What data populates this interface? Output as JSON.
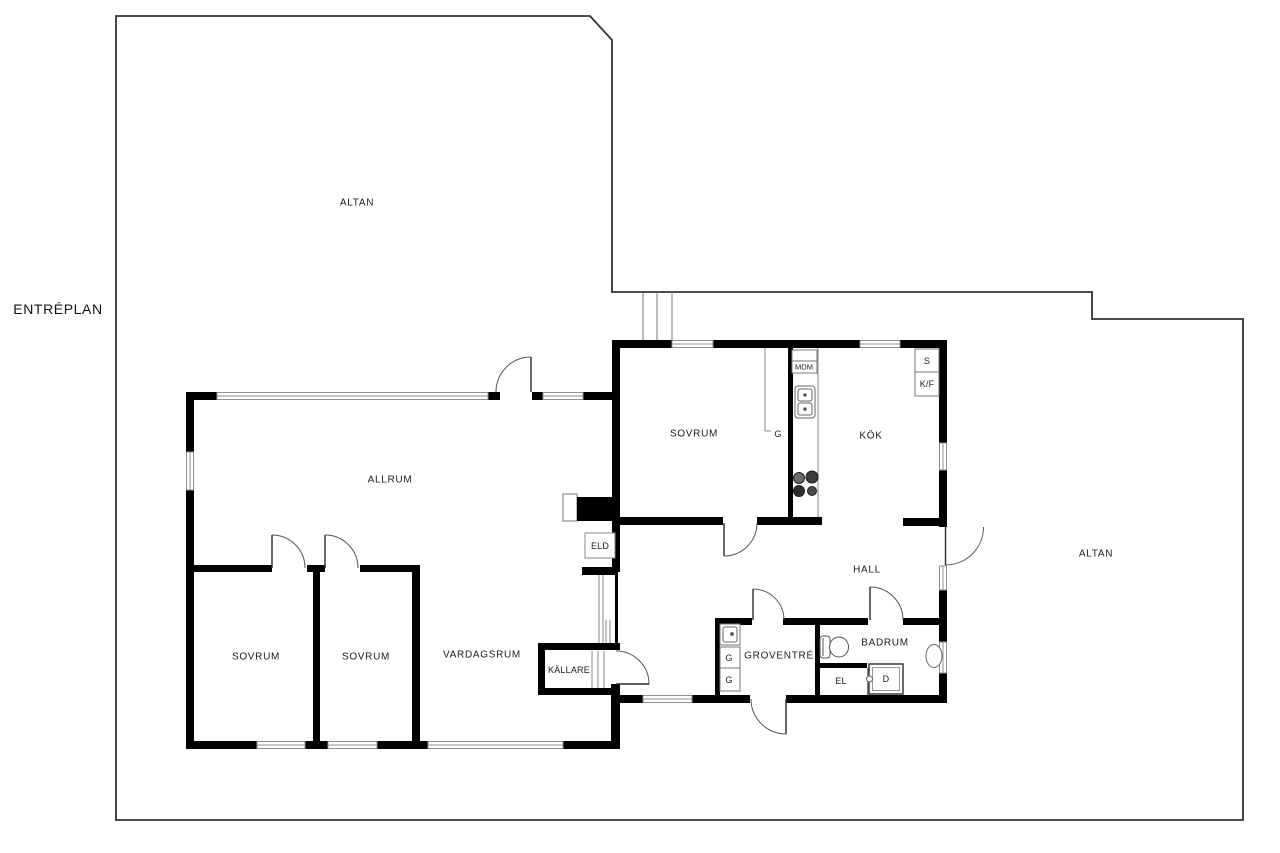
{
  "title": "ENTRÉPLAN",
  "rooms": {
    "altan_nw": "ALTAN",
    "altan_east": "ALTAN",
    "sovrum_north": "SOVRUM",
    "kok": "KÖK",
    "allrum": "ALLRUM",
    "hall": "HALL",
    "sovrum_west": "SOVRUM",
    "sovrum_mid": "SOVRUM",
    "vardagsrum": "VARDAGSRUM",
    "kallare": "KÄLLARE",
    "groventre": "GROVENTRÉ",
    "badrum": "BADRUM"
  },
  "fixtures": {
    "eld": "ELD",
    "el": "EL",
    "mdm": "MDM",
    "s": "S",
    "kf": "K/F",
    "d": "D",
    "g_sovrum": "G",
    "g_groventre_1": "G",
    "g_groventre_2": "G"
  },
  "colors": {
    "wall": "#000000",
    "deck_outline": "#333333",
    "window_frame": "#909090",
    "door_arc": "#555555",
    "text": "#1b1b1b",
    "background": "#ffffff"
  }
}
